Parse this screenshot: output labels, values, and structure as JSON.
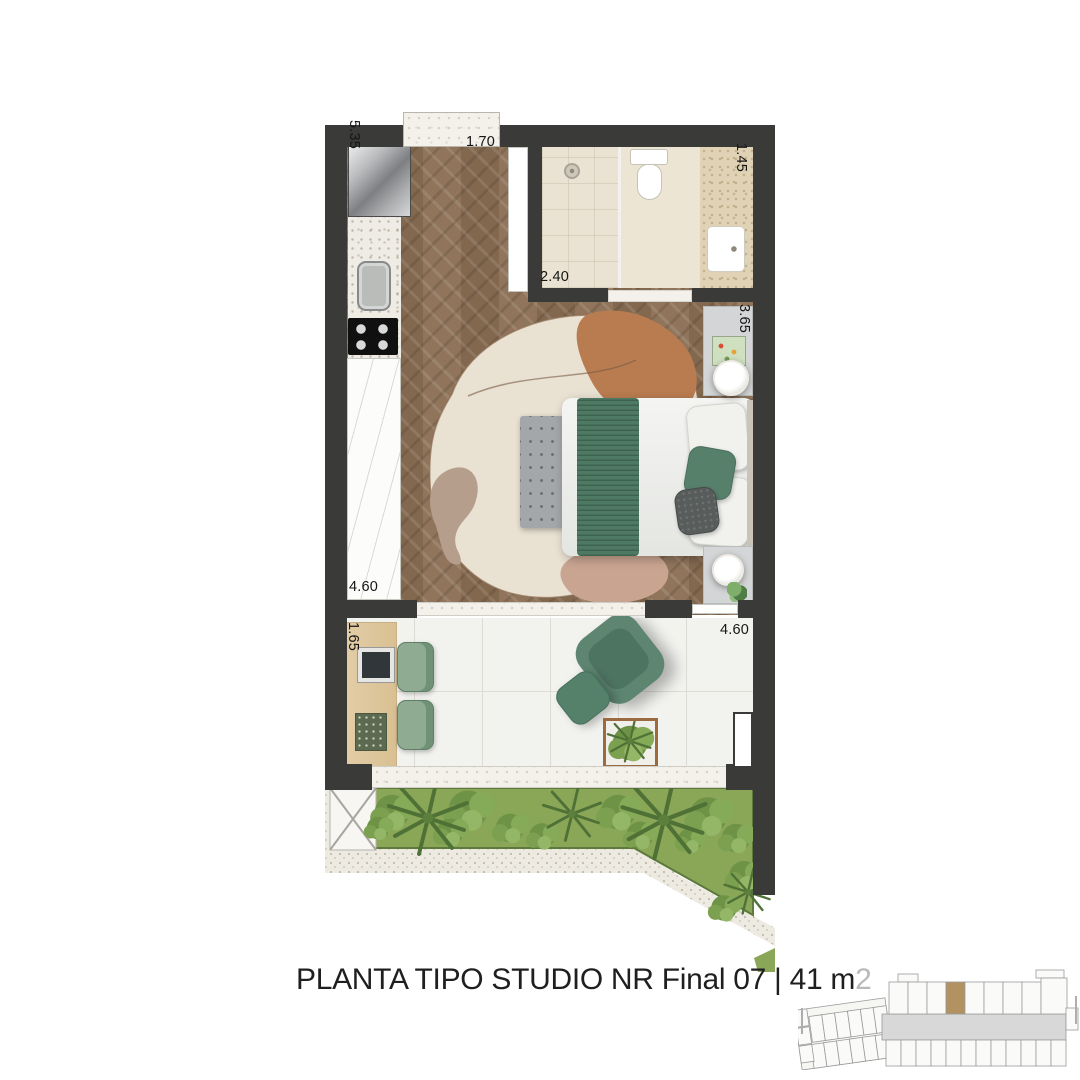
{
  "title": {
    "text": "PLANTA TIPO STUDIO NR Final 07 | 41 m",
    "superscript": "2"
  },
  "dimensions": {
    "kitchen_side": "5.35",
    "entry_top": "1.70",
    "bath_right": "1.45",
    "bath_inner": "2.40",
    "bedroom_right": "3.65",
    "wardrobe_side": "4.60",
    "desk_side": "1.65",
    "terrace_right": "4.60"
  },
  "colors": {
    "wall": "#3a3a38",
    "wood_floor": "#8a6e53",
    "bath_floor": "#eae3d3",
    "bath_marble": "#e0d2b4",
    "balcony_floor": "#f2f2ef",
    "garden_green": "#8aa657",
    "garden_border": "#5d7a3c",
    "furniture_green": "#5d8570",
    "rug_cream": "#e9e1d2",
    "rug_terracotta": "#b97c50",
    "rug_pink": "#c9a491",
    "desk_wood": "#e3cda6",
    "title_color": "#1f1f1f",
    "title_sup": "#b9b9b9",
    "site_highlight": "#b29261",
    "site_outline": "#9a9a9a",
    "site_corridor": "#d8d8d8"
  }
}
